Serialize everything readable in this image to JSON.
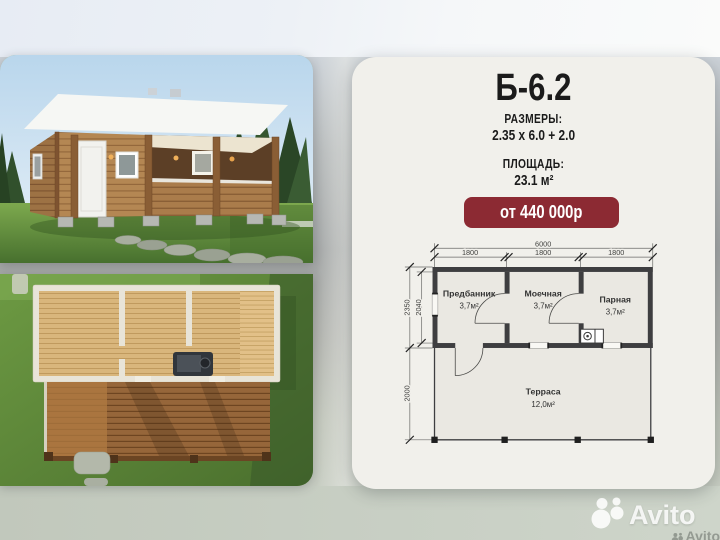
{
  "theme": {
    "accent": "#8c2a33",
    "card_bg": "#f1f0eb",
    "text": "#1b1b1b",
    "plan_wall": "#3e3e40"
  },
  "card": {
    "title": "Б-6.2",
    "sizes_label": "РАЗМЕРЫ:",
    "sizes_value": "2.35 x 6.0 + 2.0",
    "area_label": "ПЛОЩАДЬ:",
    "area_value": "23.1 м²",
    "price": "от 440 000р"
  },
  "floor_plan": {
    "dim_top_total": "6000",
    "dim_top_segments": [
      "1800",
      "1800",
      "1800"
    ],
    "dim_left_outer": "2350",
    "dim_left_inner": "2040",
    "dim_left_bottom": "2000",
    "rooms": [
      {
        "name": "Предбанник",
        "area": "3,7м²"
      },
      {
        "name": "Моечная",
        "area": "3,7м²"
      },
      {
        "name": "Парная",
        "area": "3,7м²"
      },
      {
        "name": "Терраса",
        "area": "12,0м²"
      }
    ]
  },
  "watermark": {
    "brand": "Avito"
  }
}
